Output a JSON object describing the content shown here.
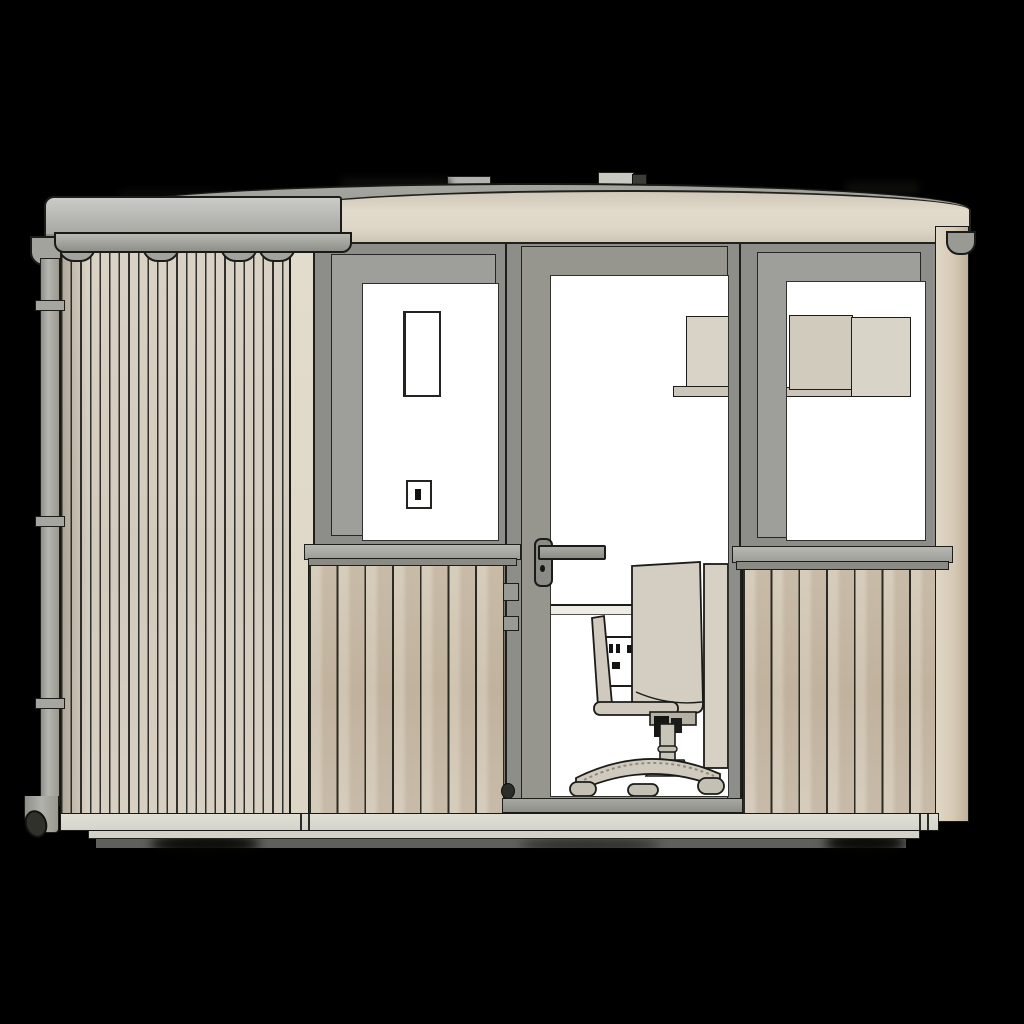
{
  "viewport": {
    "label": "3D architectural render viewport",
    "background_color": "#000000",
    "subject": "Garden office room, front elevation CAD render"
  },
  "building": {
    "roof": {
      "label": "Curved roof",
      "surface_color": "#a0a099",
      "front_fascia": {
        "label": "Curved front fascia board",
        "color": "#ded7c8"
      },
      "side_fascia": {
        "label": "Left side fascia / gutter board",
        "color": "#b3b3af"
      },
      "vents": {
        "count": 2,
        "color": "#c9c9c4"
      }
    },
    "rainwater": {
      "gutter": {
        "label": "Half-round gutter",
        "color": "#a3a39e",
        "bracket_count": 4
      },
      "gutter_end_cap": {
        "label": "Gutter stop end",
        "color": "#9a9a95"
      },
      "downpipe": {
        "label": "Downpipe with elbow shoe",
        "color": "#a6a6a1",
        "clip_count": 3
      }
    },
    "left_wall": {
      "label": "Left side wall, narrow vertical slat cladding",
      "cladding_color": "#d6cfc2",
      "slat_style": "narrow vertical battens"
    },
    "front_wall": {
      "label": "Front elevation wall",
      "color": "#e0d9ca",
      "corner_trim": {
        "label": "Right corner trim board",
        "color": "#d2c7b3"
      }
    },
    "left_window": {
      "label": "Left casement window",
      "frame_color": "#8d8d89",
      "glazing_color": "#ffffff",
      "interior_items": [
        "tall framed panel on back wall",
        "light switch"
      ],
      "sill_color": "#a8a8a3",
      "apron": {
        "label": "Wide slat apron panel",
        "color": "#cdc1ae"
      }
    },
    "door": {
      "label": "Glazed entrance door",
      "frame_color": "#8d8d89",
      "leaf_color": "#96968f",
      "glazing_color": "#ffffff",
      "hardware": [
        "lever handle",
        "escutcheon",
        "two hinges",
        "doorstop",
        "threshold"
      ],
      "interior_items": [
        "wall cabinet",
        "wall shelf",
        "desk edge",
        "double power socket",
        "office swivel chair on castors"
      ]
    },
    "right_window": {
      "label": "Right casement window",
      "frame_color": "#8d8d89",
      "glazing_color": "#ffffff",
      "interior_items": [
        "two-door wall cabinet with shelf lip"
      ],
      "sill_color": "#a8a8a3",
      "apron": {
        "label": "Wide slat apron panel",
        "color": "#cdc1ae"
      }
    },
    "interior": {
      "furniture_color": "#d2cdc0",
      "chair": {
        "label": "Office chair, five-star base",
        "color": "#d2cdc0",
        "detail_color": "#1b1b18"
      }
    },
    "base": {
      "skirting": {
        "label": "Base skirting board",
        "color": "#dcdbd2"
      },
      "plinth_step": {
        "color": "#d3d2c9"
      },
      "foundation": {
        "label": "Foundation shadow line",
        "color": "#5f5f5b"
      }
    }
  }
}
